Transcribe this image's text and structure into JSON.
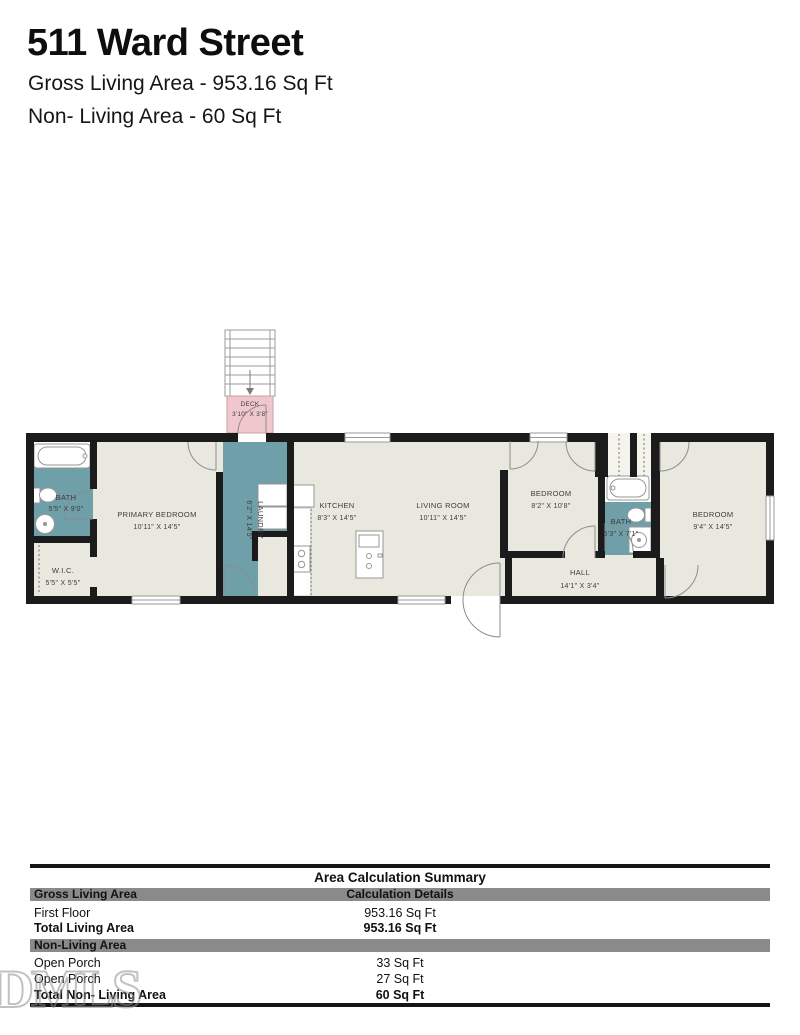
{
  "header": {
    "title": "511 Ward Street",
    "gross_line": "Gross Living Area - 953.16 Sq Ft",
    "nonliving_line": "Non- Living Area - 60 Sq Ft"
  },
  "floorplan": {
    "colors": {
      "floor": "#e9e8de",
      "wet_room": "#6f9fa9",
      "deck": "#efc7cc",
      "wall": "#1b1b1b"
    },
    "rooms": [
      {
        "id": "bath-1",
        "name": "BATH",
        "dims": "5'5\" X 9'0\""
      },
      {
        "id": "wic",
        "name": "W.I.C.",
        "dims": "5'5\" X 5'5\""
      },
      {
        "id": "primary-bedroom",
        "name": "PRIMARY BEDROOM",
        "dims": "10'11\" X 14'5\""
      },
      {
        "id": "laundry",
        "name": "LAUNDRY",
        "dims": "6'2\" X 14'5\""
      },
      {
        "id": "kitchen",
        "name": "KITCHEN",
        "dims": "8'3\" X 14'5\""
      },
      {
        "id": "living-room",
        "name": "LIVING ROOM",
        "dims": "10'11\" X 14'5\""
      },
      {
        "id": "bedroom-middle",
        "name": "BEDROOM",
        "dims": "8'2\" X 10'8\""
      },
      {
        "id": "bath-2",
        "name": "BATH",
        "dims": "5'3\" X 7'1\""
      },
      {
        "id": "bedroom-right",
        "name": "BEDROOM",
        "dims": "9'4\" X 14'5\""
      },
      {
        "id": "hall",
        "name": "HALL",
        "dims": "14'1\" X 3'4\""
      },
      {
        "id": "deck",
        "name": "DECK",
        "dims": "3'10\" X 3'8\""
      }
    ]
  },
  "summary_table": {
    "title": "Area Calculation Summary",
    "col2_header": "Calculation Details",
    "sections": [
      {
        "header": "Gross Living Area",
        "rows": [
          {
            "label": "First Floor",
            "value": "953.16 Sq Ft"
          },
          {
            "label": "Total Living Area",
            "value": "953.16 Sq Ft"
          }
        ]
      },
      {
        "header": "Non-Living Area",
        "rows": [
          {
            "label": "Open Porch",
            "value": "33 Sq Ft"
          },
          {
            "label": "Open Porch",
            "value": "27 Sq Ft"
          },
          {
            "label": "Total Non- Living Area",
            "value": "60 Sq Ft"
          }
        ]
      }
    ]
  },
  "watermark": {
    "text": "DMLS"
  }
}
